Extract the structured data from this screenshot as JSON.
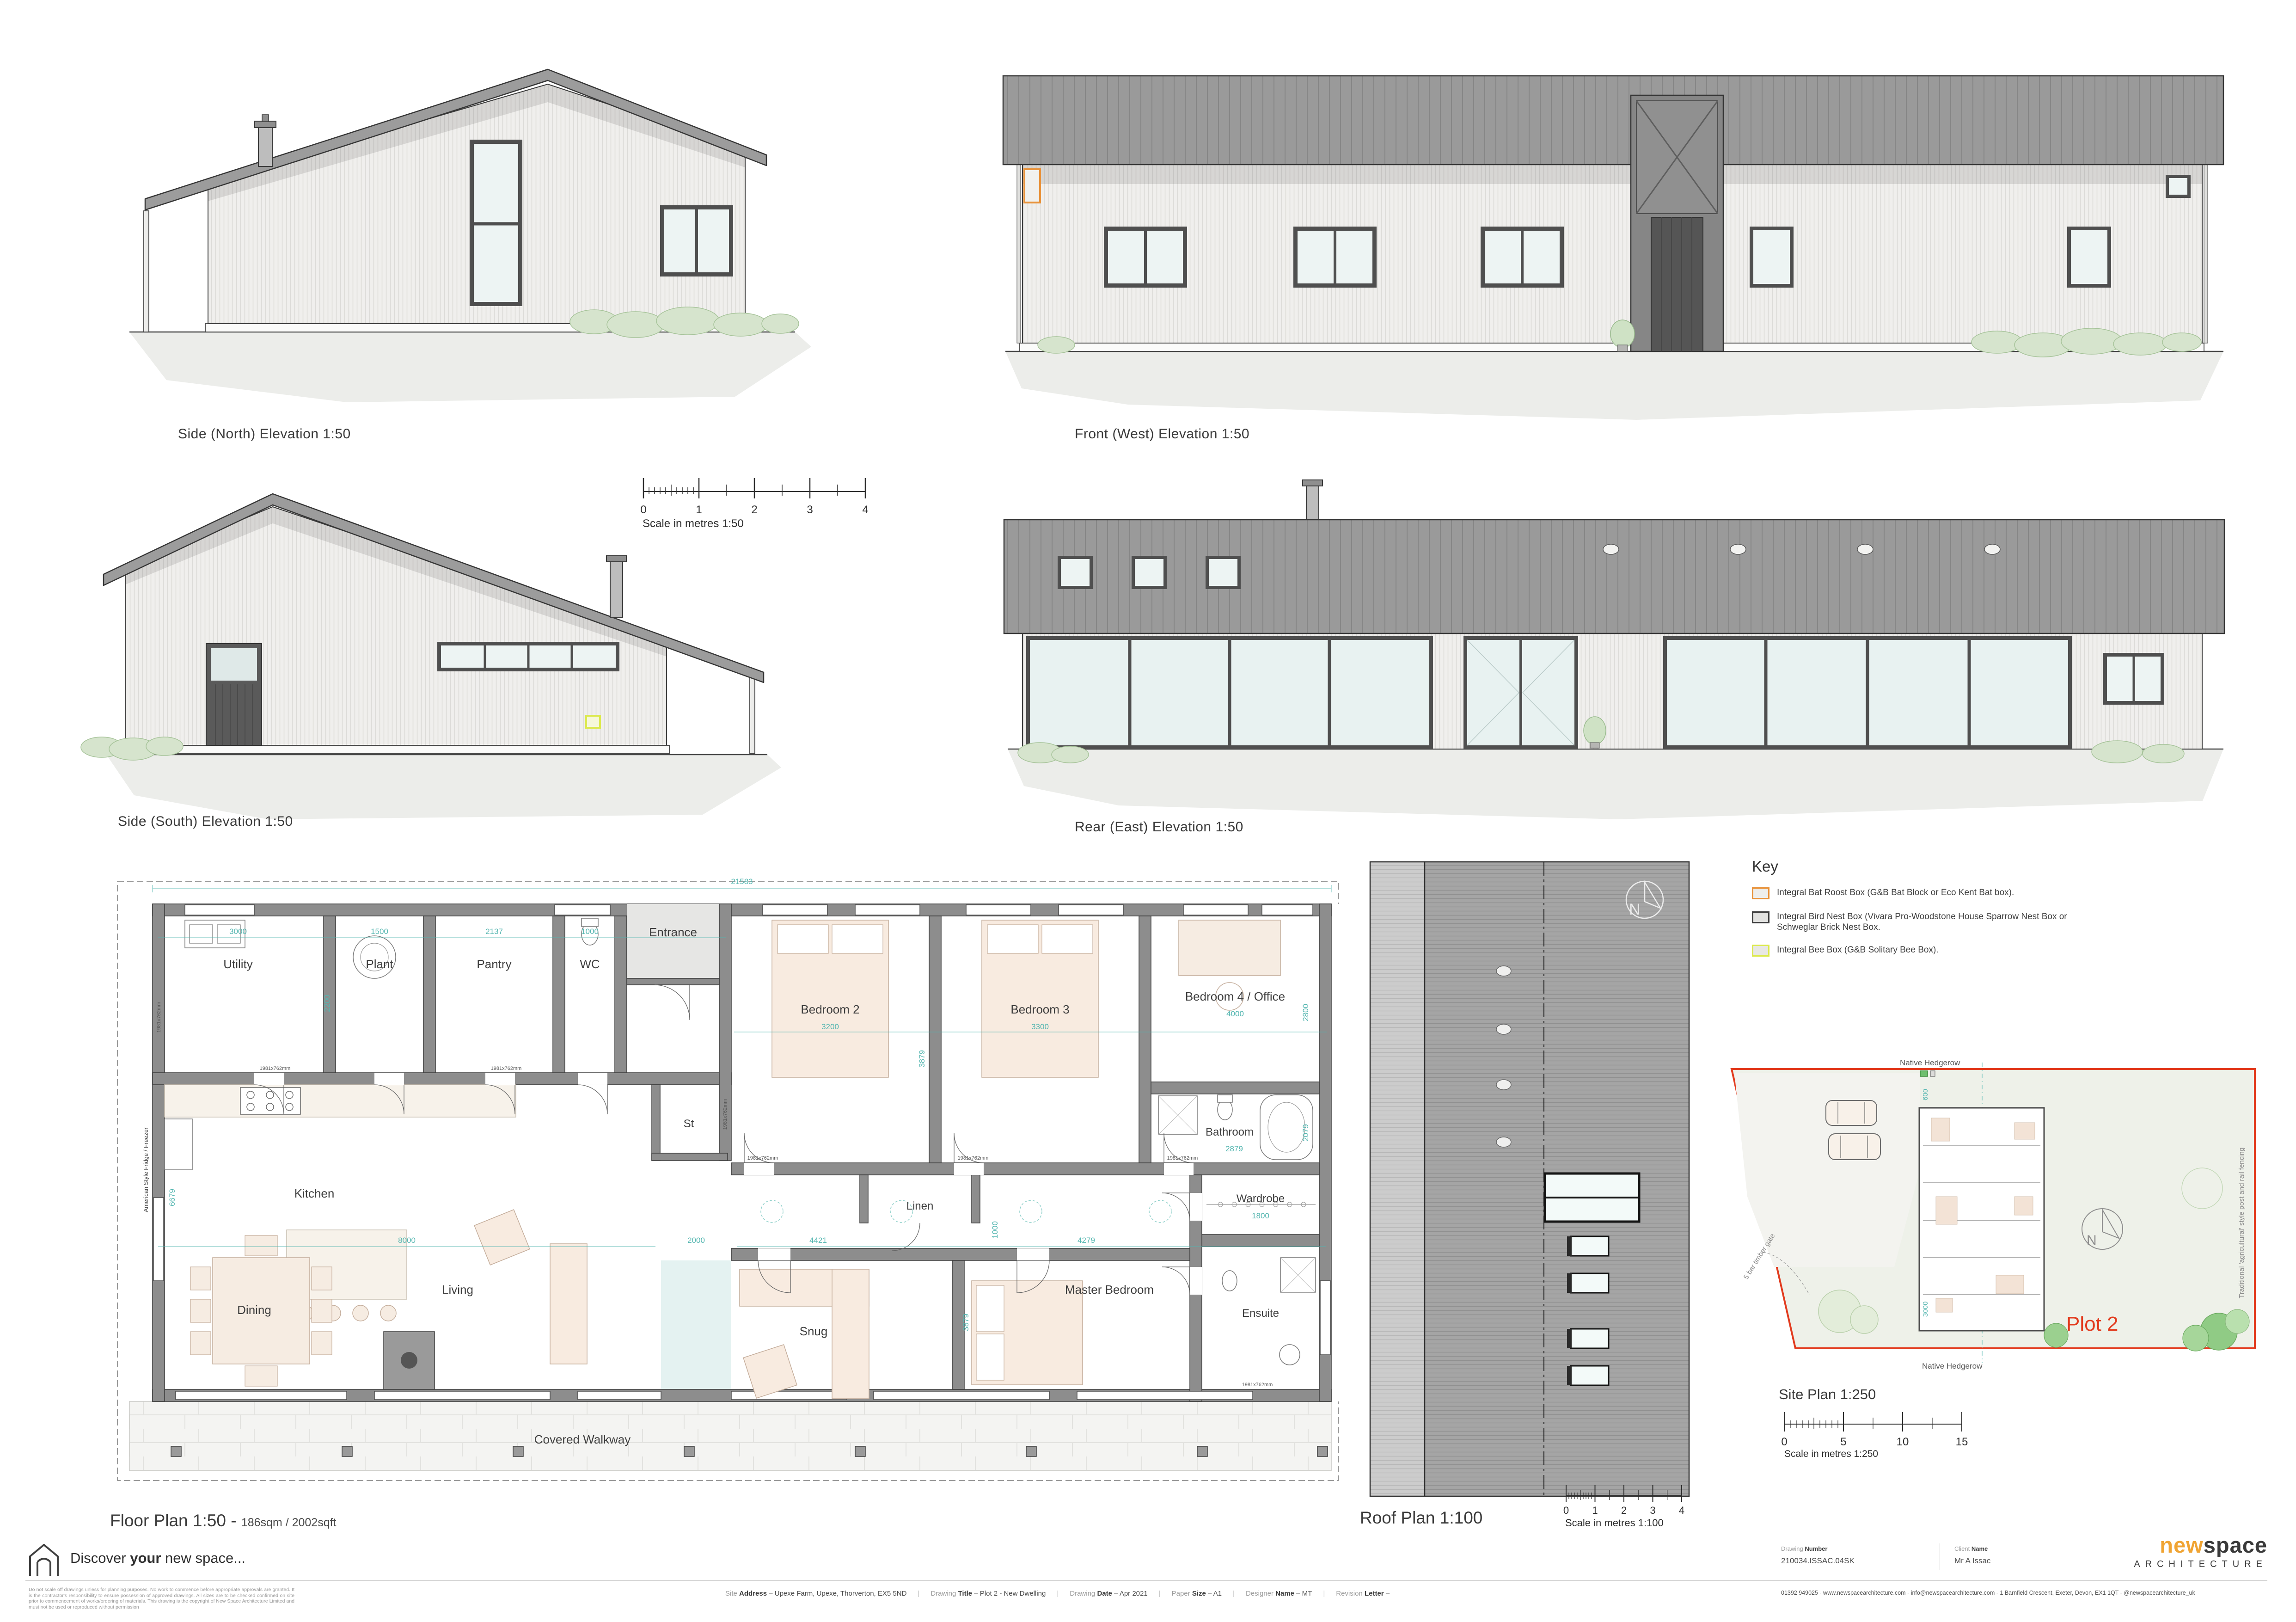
{
  "colors": {
    "plot_red": "#e23b1e",
    "dim_teal": "#54b6b0",
    "brand_orange": "#f0a433",
    "bat_box_orange": "#e8923a",
    "bird_box_gray": "#3f3f3f",
    "bee_box_yellow": "#dce94f"
  },
  "elevations": {
    "north": "Side (North) Elevation 1:50",
    "front": "Front (West) Elevation 1:50",
    "south": "Side (South) Elevation 1:50",
    "rear": "Rear (East) Elevation 1:50"
  },
  "scales": {
    "s50": {
      "ticks": [
        "0",
        "1",
        "2",
        "3",
        "4"
      ],
      "caption": "Scale in metres 1:50"
    },
    "s100": {
      "ticks": [
        "0",
        "1",
        "2",
        "3",
        "4"
      ],
      "caption": "Scale in metres 1:100"
    },
    "s250": {
      "ticks": [
        "0",
        "5",
        "10",
        "15"
      ],
      "caption": "Scale in metres 1:250"
    }
  },
  "floor_plan": {
    "title": "Floor Plan 1:50 -",
    "area": "186sqm / 2002sqft",
    "door_tag": "1981x762mm",
    "rooms": {
      "utility": "Utility",
      "plant": "Plant",
      "pantry": "Pantry",
      "wc": "WC",
      "entrance": "Entrance",
      "st": "St",
      "kitchen": "Kitchen",
      "linen": "Linen",
      "bedroom2": "Bedroom 2",
      "bedroom3": "Bedroom 3",
      "bedroom4": "Bedroom 4 / Office",
      "bathroom": "Bathroom",
      "wardrobe": "Wardrobe",
      "ensuite": "Ensuite",
      "dining": "Dining",
      "living": "Living",
      "snug": "Snug",
      "master": "Master Bedroom",
      "walkway": "Covered Walkway",
      "fridge": "American Style Fridge / Freezer"
    },
    "dims": {
      "overall": "21583",
      "utility": "3000",
      "plant": "1500",
      "pantry": "2137",
      "wc": "1000",
      "utility_depth": "2200",
      "bed2": "3200",
      "bed3": "3300",
      "bed_depth": "3879",
      "bed4": "4000",
      "bed4_depth": "2800",
      "hall": "1000",
      "living": "8000",
      "living_depth": "6679",
      "glazed": "2000",
      "snug": "4421",
      "master": "4279",
      "master_depth": "3879",
      "wardrobe": "1800",
      "bathroom": "2879",
      "bathroom_depth": "2079"
    }
  },
  "roof_plan": {
    "title": "Roof Plan 1:100",
    "north": "N"
  },
  "key": {
    "title": "Key",
    "items": [
      {
        "label": "Integral Bat Roost Box (G&B Bat Block or Eco Kent Bat box)."
      },
      {
        "label": "Integral Bird Nest Box (Vivara Pro-Woodstone House Sparrow Nest Box or Schweglar Brick Nest Box."
      },
      {
        "label": "Integral Bee Box (G&B Solitary Bee Box)."
      }
    ]
  },
  "site_plan": {
    "title": "Site Plan 1:250",
    "plot": "Plot 2",
    "hedgerow_top": "Native Hedgerow",
    "hedgerow_bottom": "Native Hedgerow",
    "fencing": "Traditional 'agricultural' style post and rail fencing",
    "gate": "5 bar timber gate",
    "dim_a": "600",
    "dim_b": "3000",
    "north": "N"
  },
  "sheet": {
    "tagline_pre": "Discover ",
    "tagline_bold": "your",
    "tagline_post": " new space...",
    "disclaimer": "Do not scale off drawings unless for planning purposes. No work to commence before appropriate approvals are granted. It is the contractor's responsibility to ensure possession of approved drawings. All sizes are to be checked confirmed on site prior to commencement of works/ordering of materials. This drawing is the copyright of New Space Architecture Limited and must not be used or reproduced without permission"
  },
  "title_block": {
    "fields": [
      {
        "pre": "Site",
        "bold": "Address",
        "value": "–  Upexe Farm, Upexe, Thorverton, EX5 5ND"
      },
      {
        "pre": "Drawing",
        "bold": "Title",
        "value": "–  Plot 2 - New Dwelling"
      },
      {
        "pre": "Drawing",
        "bold": "Date",
        "value": "–  Apr 2021"
      },
      {
        "pre": "Paper",
        "bold": "Size",
        "value": "–  A1"
      },
      {
        "pre": "Designer",
        "bold": "Name",
        "value": "–  MT"
      },
      {
        "pre": "Revision",
        "bold": "Letter",
        "value": "–"
      }
    ],
    "number_pre": "Drawing",
    "number_bold": "Number",
    "number": "210034.ISSAC.04SK",
    "client_pre": "Client",
    "client_bold": "Name",
    "client": "Mr A Issac",
    "brand_a": "new",
    "brand_b": "space",
    "brand_sub": "ARCHITECTURE",
    "contact": "01392 949025 - www.newspacearchitecture.com -  info@newspacearchitecture.com - 1 Barnfield Crescent, Exeter, Devon, EX1 1QT - @newspacearchitecture_uk"
  }
}
